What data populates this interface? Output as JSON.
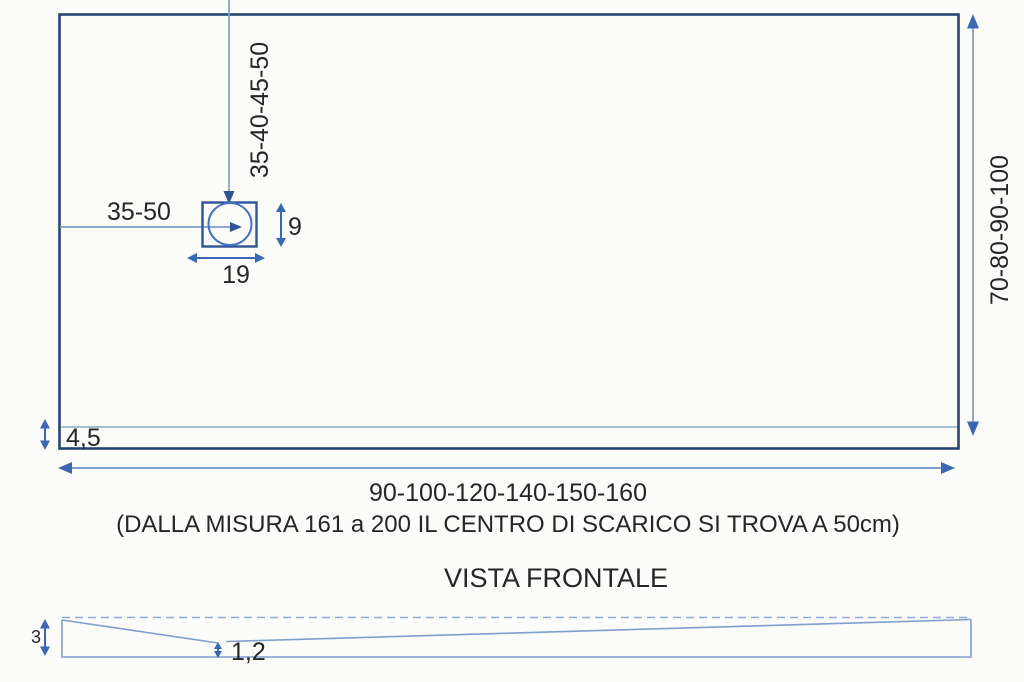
{
  "diagram": {
    "type": "technical-drawing",
    "subject": "shower tray dimensions",
    "top_view": {
      "drain_vertical_offset": "35-40-45-50",
      "drain_horizontal_offset": "35-50",
      "drain_height": "9",
      "drain_width": "19",
      "tray_depth": "70-80-90-100",
      "border_thickness": "4,5",
      "tray_length": "90-100-120-140-150-160",
      "drain_note": "(DALLA MISURA 161 a 200 IL CENTRO DI SCARICO SI TROVA A 50cm)"
    },
    "front_view": {
      "title": "VISTA FRONTALE",
      "edge_height": "3",
      "min_center_height": "1,2"
    },
    "colors": {
      "tray_outline": "#24466e",
      "drain_outline": "#2f5496",
      "thin_line": "#7f9fce",
      "dimension_arrow": "#3b68b5",
      "text": "#262626",
      "background": "#fcfcfb"
    }
  }
}
